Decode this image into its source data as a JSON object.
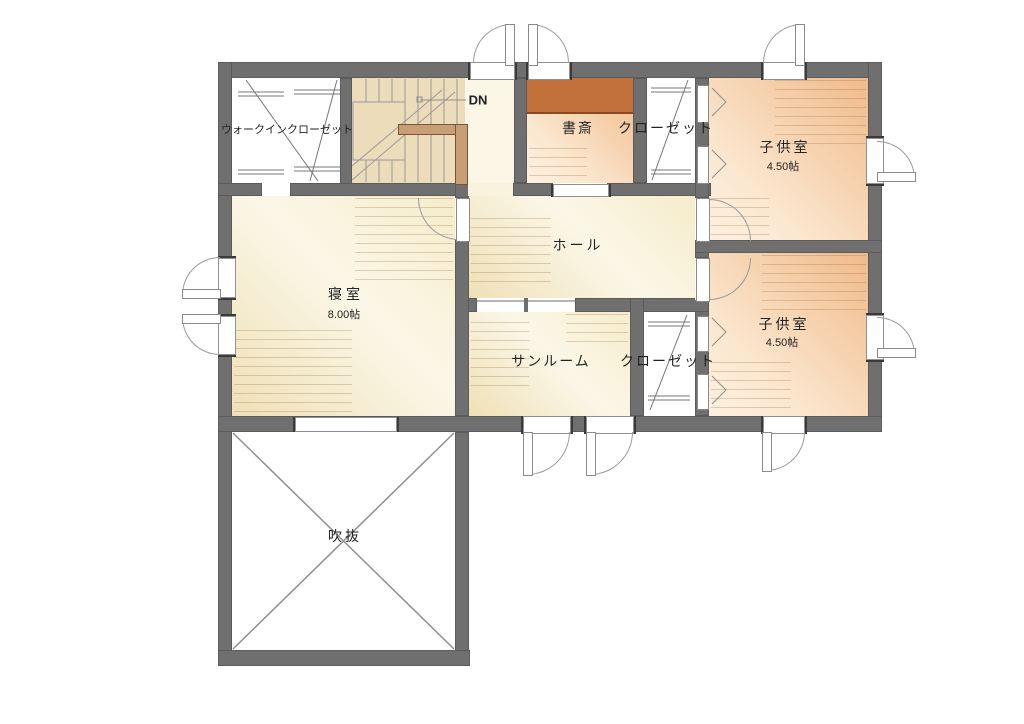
{
  "plan": {
    "rooms": {
      "walk_in_closet": {
        "label": "ウォークインクローゼット"
      },
      "stairs": {
        "down_label": "DN"
      },
      "study": {
        "label": "書斎"
      },
      "closet_upper": {
        "label": "クローゼット"
      },
      "kids_room_upper": {
        "label": "子供室",
        "size": "4.50帖"
      },
      "hall": {
        "label": "ホール"
      },
      "bedroom": {
        "label": "寝室",
        "size": "8.00帖"
      },
      "sunroom": {
        "label": "サンルーム"
      },
      "closet_lower": {
        "label": "クローゼット"
      },
      "kids_room_lower": {
        "label": "子供室",
        "size": "4.50帖"
      },
      "void": {
        "label": "吹抜"
      }
    },
    "colors": {
      "wall": "#6f6f6f",
      "line": "#8f8f8f",
      "floor_cream": "#f6ecca",
      "floor_cream_light": "#fbf7e8",
      "floor_peach": "#f0ba8a",
      "floor_peach_light": "#fbe7cf",
      "floor_stairs": "#ecdcba",
      "desk": "#c2713a",
      "handrail": "#c79e75"
    }
  }
}
